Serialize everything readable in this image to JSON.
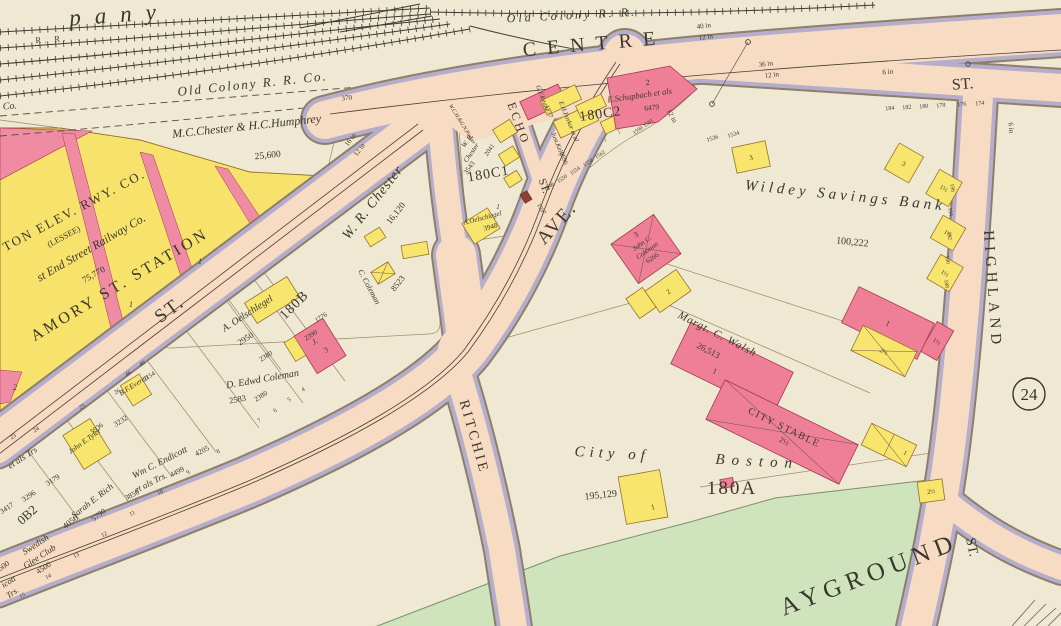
{
  "map": {
    "colors": {
      "paper": "#efe8d2",
      "street": "#f7dbc3",
      "sidewalk": "#b5aecb",
      "frame_building": "#f8e56d",
      "brick_building": "#ef7e97",
      "playground": "#cfe4bd"
    },
    "streets": {
      "centre": "CENTRE",
      "st_top_right": "ST.",
      "highland": "HIGHLAND",
      "st_bottom_right": "ST.",
      "avenue": "AVE.",
      "echo": "ECHO",
      "echo_st": "ST.",
      "ritchie": "RITCHIE",
      "amory": "ST."
    },
    "railroad": {
      "company_partial": "pany",
      "rr": "R. R.",
      "co_partial": "Co.",
      "old_colony": "Old Colony R. R.",
      "old_colony_co": "Old Colony R. R. Co.",
      "lot_370": "370"
    },
    "blocks": {
      "c1": "180C1",
      "c2": "180C2",
      "b": "180B",
      "b2_partial": "0B2",
      "a": "180A",
      "plate": "24"
    },
    "parcels": {
      "chester_humphrey": "M.C.Chester & H.C.Humphrey",
      "chester_humphrey_area": "25,600",
      "elev_rwy": "TON ELEV. RWY. CO.",
      "lessee": "(LESSEE)",
      "west_end": "st End Street Railway Co.",
      "west_end_area": "75,770",
      "amory_station": "AMORY ST. STATION",
      "wr_chester": "W. R. Chester",
      "wr_chester_area": "16,120",
      "area_8523": "8523",
      "wr_chester2_l1": "W. R.",
      "wr_chester2_l2": "Chester",
      "area_3543": "3543",
      "area_2041": "2041",
      "parker_long": "W.C.H.&G.N.Parker",
      "oelschlegel_c1": "A.Oelschlegel",
      "area_3948": "3948",
      "keane": "G.F.Keane",
      "area_1777": "1777",
      "parker": "E.H.Parker et al",
      "kelly": "Just.Kelly",
      "area_2596": "2596",
      "schupbach": "E.Schupbach et als",
      "area_6479": "6479",
      "schupbach_no": "2",
      "wildey": "Wildey Savings Bank",
      "wildey_area": "100,222",
      "coleman_l1": "John C.",
      "coleman_l2": "Coleman",
      "coleman_area": "6266",
      "coleman_no": "3",
      "walsh": "Margt. C. Walsh",
      "walsh_area": "26,513",
      "city_stable": "CITY STABLE",
      "city_of": "City of",
      "boston": "Boston",
      "city_area": "195,129",
      "playground_partial": "AYGROUND",
      "oelschlegel_b": "A. Oelschlegel",
      "area_2950": "2950",
      "d_coleman": "D. Edwd Coleman",
      "c_coleman": "C. Coleman",
      "jc": "J.",
      "jc_no": "3",
      "area_1776": "1776",
      "area_2390": "2390",
      "area_2380a": "2380",
      "area_2380b": "2380",
      "area_2583": "2583",
      "tyler": "John E.Tyler",
      "area_5936": "5936",
      "bf": "B.F.Everett",
      "area_2154": "2154",
      "area_3232": "3232",
      "endicott_l1": "Wm C. Endicott",
      "endicott_l2": "et als Trs.",
      "area_3850": "3850",
      "area_4499": "4499",
      "area_4205": "4205",
      "rich": "Sarah E. Rich",
      "area_5790": "5790",
      "area_4050": "4050",
      "etals": "et als Trs",
      "area_3417": "3417",
      "area_3296": "3296",
      "area_3179": "3179",
      "swedish_l1": "Swedish",
      "swedish_l2": "Glee Club",
      "area_4500": "4500",
      "area_500": "500",
      "icott": "icott",
      "trs": "Trs."
    },
    "pipes": {
      "p40": "40 in",
      "p12a": "12 in",
      "p36": "36 in",
      "p12b": "12 in",
      "p6a": "6 in",
      "p16": "16 in",
      "p12c": "12 in",
      "p12d": "12 in",
      "p6b": "6 in"
    },
    "house_numbers": {
      "h184": "184",
      "h182": "182",
      "h180": "180",
      "h178": "178",
      "h176": "176",
      "h174": "174",
      "h1536": "1536",
      "h1534": "1534",
      "h1597": "1597",
      "f1546": "1546",
      "f1550": "1550",
      "f1554": "1554",
      "f1558": "1558",
      "f1562": "1562",
      "f1590": "1590 1591",
      "hl196": "196",
      "hl194": "194",
      "hl192": "192",
      "hl190": "190",
      "hl188": "188"
    },
    "lot_numbers": {
      "l23": "23",
      "l24": "24",
      "l25": "25",
      "l26": "26",
      "l46": "46",
      "l40": "40",
      "l4": "4",
      "l5": "5",
      "l6": "6",
      "l7": "7",
      "l8": "8",
      "l9": "9",
      "l10": "10",
      "l11": "11",
      "l12": "12",
      "l13": "13",
      "l14": "14",
      "l15": "15",
      "u1a": "1",
      "u1b": "1",
      "u2": "2",
      "c1_1": "1"
    },
    "building_numbers": {
      "b3a": "3",
      "b3b": "3",
      "h15a": "1½",
      "h15b": "1½",
      "h15c": "1½",
      "h15d": "1½",
      "w1": "1",
      "n1": "1",
      "st25": "2½",
      "shp25": "2½",
      "shq1": "1",
      "r1": "1",
      "t25": "2½",
      "l2": "2"
    }
  }
}
